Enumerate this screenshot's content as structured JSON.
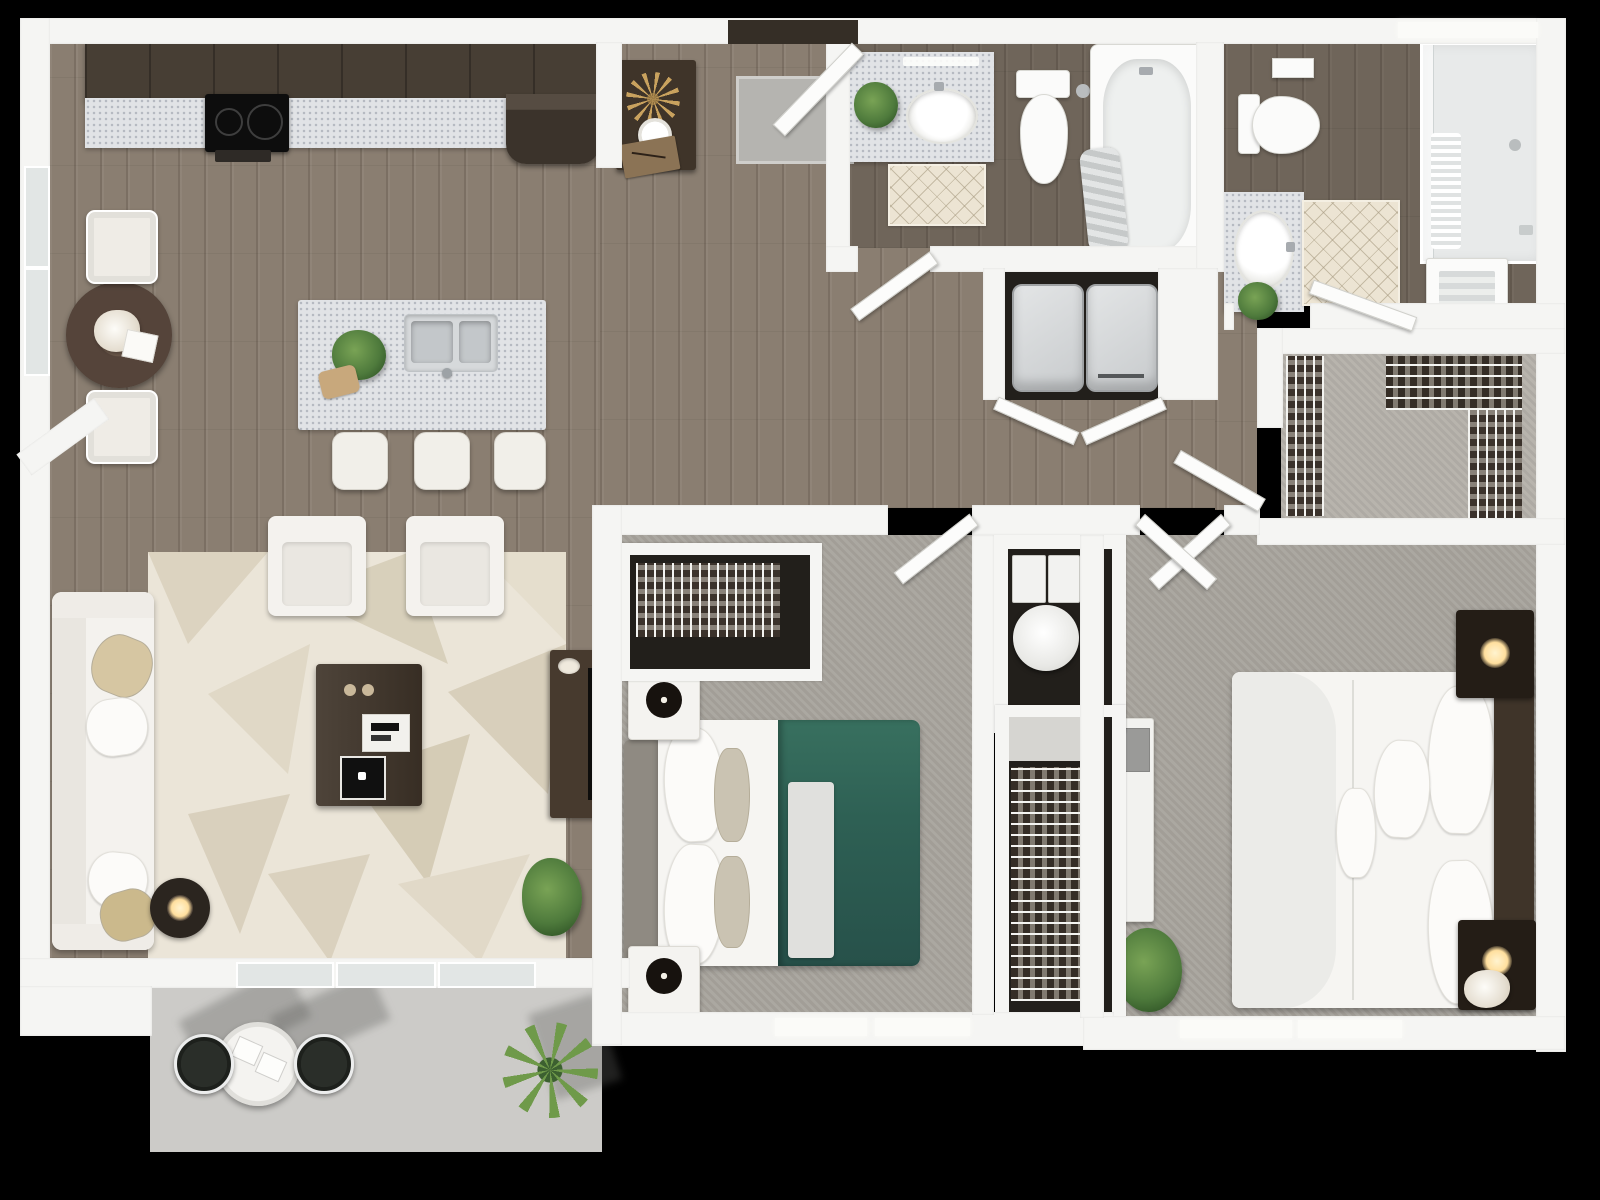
{
  "meta": {
    "render_type": "3D top-down apartment floor plan",
    "unit_summary": "2 bedroom, 2 bathroom apartment with open kitchen/living area, laundry closet, walk-in closet and patio",
    "visible_text": "none"
  },
  "palette": {
    "black_bg": "#000000",
    "wall": "#f5f5f3",
    "wood": "#8a7e71",
    "carpet": "#a7a39c",
    "carpet_light": "#b4b0a9",
    "granite": "#e1e3e6",
    "cabinet_wood": "#473e34",
    "teal_bedding": "#2e6054",
    "patio_concrete": "#cccbc8",
    "rug_cream": "#ebe5d8",
    "plant_green": "#4e7a3c",
    "lamp_glow": "#ffdf9e",
    "closet_interior": "#221f1b",
    "porcelain": "#fbfbfa",
    "accent_dark_wood": "#3f3429"
  },
  "rooms": {
    "kitchen": {
      "label": "Kitchen",
      "features": [
        "dark wood cabinets",
        "quartz counter",
        "cooktop",
        "refrigerator",
        "island with double sink",
        "three bar stools"
      ]
    },
    "dining": {
      "label": "Dining nook",
      "features": [
        "round wood table",
        "two upholstered benches",
        "centerpiece flowers"
      ]
    },
    "living": {
      "label": "Living room",
      "features": [
        "white sectional sofa",
        "two armchairs",
        "geometric rug",
        "wood coffee table",
        "media console with TV",
        "drum side lamp",
        "floor plant",
        "sliding patio door"
      ]
    },
    "entry": {
      "label": "Entry",
      "features": [
        "front door with swing",
        "console table with gold starburst decor",
        "doormat"
      ]
    },
    "hall": {
      "label": "Hallway",
      "features": [
        "wood flooring"
      ]
    },
    "bath1": {
      "label": "Main bathroom",
      "features": [
        "granite vanity with oval sink",
        "plant",
        "lattice rug",
        "toilet",
        "bathtub with draped towel"
      ]
    },
    "laundry": {
      "label": "Laundry closet",
      "features": [
        "washer",
        "dryer",
        "bifold doors"
      ]
    },
    "utility": {
      "label": "Utility closet",
      "features": [
        "HVAC unit",
        "water heater tank"
      ]
    },
    "bedroom1": {
      "label": "Bedroom",
      "features": [
        "bed with teal duvet",
        "gray headboard",
        "two white nightstands with black lamps",
        "reach-in closet with wire shelving",
        "two windows"
      ]
    },
    "linen": {
      "label": "Linen / shoe closet",
      "features": [
        "wire shelving"
      ]
    },
    "master": {
      "label": "Primary bedroom",
      "features": [
        "white bed with dark tufted headboard",
        "two dark nightstands with lamps",
        "dresser with TV",
        "floor plant",
        "two windows"
      ]
    },
    "walkin": {
      "label": "Walk-in closet",
      "features": [
        "wire shelving with hanging clothes on both sides"
      ]
    },
    "bath2": {
      "label": "En-suite bathroom",
      "features": [
        "toilet",
        "glass walk-in shower with bench",
        "granite vanity with oval sink",
        "lattice rug",
        "towel cabinet"
      ]
    },
    "patio": {
      "label": "Patio",
      "features": [
        "round bistro table",
        "two dark chairs",
        "spiky potted plant",
        "concrete slab"
      ]
    }
  }
}
